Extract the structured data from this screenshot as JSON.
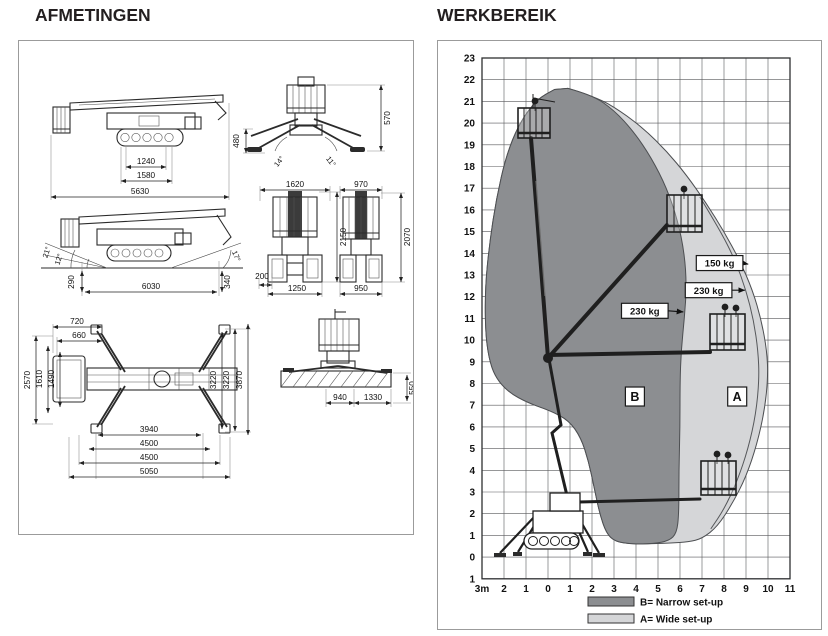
{
  "left_panel": {
    "title": "AFMETINGEN",
    "side_view_stowed": {
      "v1": "1240",
      "v2": "1580",
      "v3": "5630"
    },
    "rear_view_outriggers": {
      "h_right": "570",
      "h_left": "480",
      "ang1": "14°",
      "ang2": "11°"
    },
    "side_view_grade": {
      "ang_up": "21°",
      "ang_mid": "12°",
      "ang_rear": "17°",
      "h_front": "290",
      "length": "6030",
      "h_rear": "340"
    },
    "front_view_wide": {
      "w_top": "1620",
      "height": "2150",
      "offset": "200",
      "w_track": "1250"
    },
    "front_view_narrow": {
      "w_top": "970",
      "height": "2070",
      "w_track": "950"
    },
    "plan_view": {
      "t1": "720",
      "t2": "660",
      "l1": "2570",
      "l2": "1610",
      "l3": "1490",
      "r1": "3220",
      "r2": "3220",
      "r3": "3870",
      "b1": "3940",
      "b2": "4500",
      "b3": "4500",
      "b4": "5050"
    },
    "slab_view": {
      "b1": "940",
      "b2": "1330",
      "r1": "550"
    }
  },
  "right_panel": {
    "title": "WERKBEREIK"
  },
  "chart_data": {
    "type": "area",
    "title": "WERKBEREIK",
    "x_axis": {
      "unit": "m",
      "min": -3,
      "max": 11,
      "tick_labels": [
        "3m",
        "2",
        "1",
        "0",
        "1",
        "2",
        "3",
        "4",
        "5",
        "6",
        "7",
        "8",
        "9",
        "10",
        "11"
      ]
    },
    "y_axis": {
      "unit": "m",
      "min": -1,
      "max": 23,
      "tick_labels": [
        "23",
        "22",
        "21",
        "20",
        "19",
        "18",
        "17",
        "16",
        "15",
        "14",
        "13",
        "12",
        "11",
        "10",
        "9",
        "8",
        "7",
        "6",
        "5",
        "4",
        "3",
        "2",
        "1",
        "0",
        "1"
      ]
    },
    "grid": true,
    "regions": [
      {
        "id": "A",
        "label": "A",
        "name": "Wide set-up",
        "color": "#d5d6d8",
        "outline": [
          [
            0.9,
            21.6
          ],
          [
            2.2,
            21.2
          ],
          [
            3.3,
            20.55
          ],
          [
            4.4,
            19.7
          ],
          [
            5.4,
            18.7
          ],
          [
            6.3,
            17.6
          ],
          [
            7.2,
            16.3
          ],
          [
            8.0,
            15.0
          ],
          [
            8.7,
            13.7
          ],
          [
            9.3,
            12.3
          ],
          [
            9.7,
            10.9
          ],
          [
            9.95,
            9.5
          ],
          [
            10.0,
            8.3
          ],
          [
            9.85,
            6.8
          ],
          [
            9.5,
            5.2
          ],
          [
            9.0,
            3.7
          ],
          [
            8.4,
            2.5
          ],
          [
            7.7,
            1.4
          ],
          [
            7.0,
            0.85
          ],
          [
            6.4,
            0.7
          ],
          [
            5.55,
            0.65
          ],
          [
            4.8,
            0.62
          ],
          [
            3.8,
            0.6
          ],
          [
            3.05,
            0.72
          ],
          [
            2.65,
            1.1
          ],
          [
            2.35,
            2.0
          ],
          [
            2.1,
            3.2
          ],
          [
            1.85,
            4.4
          ],
          [
            1.5,
            5.5
          ],
          [
            0.95,
            6.3
          ],
          [
            0.1,
            6.75
          ],
          [
            -0.9,
            7.1
          ],
          [
            -1.8,
            7.6
          ],
          [
            -2.4,
            8.3
          ],
          [
            -2.7,
            9.2
          ],
          [
            -2.85,
            10.5
          ],
          [
            -2.85,
            12.5
          ],
          [
            -2.65,
            14.5
          ],
          [
            -2.35,
            16.5
          ],
          [
            -1.9,
            18.5
          ],
          [
            -1.3,
            20.0
          ],
          [
            -0.5,
            21.1
          ],
          [
            0.3,
            21.55
          ]
        ]
      },
      {
        "id": "B",
        "label": "B",
        "name": "Narrow set-up",
        "color": "#8c8e91",
        "outline": [
          [
            0.9,
            21.6
          ],
          [
            2.0,
            21.3
          ],
          [
            3.0,
            20.6
          ],
          [
            3.9,
            19.6
          ],
          [
            4.7,
            18.4
          ],
          [
            5.4,
            17.0
          ],
          [
            5.9,
            15.5
          ],
          [
            6.2,
            14.0
          ],
          [
            6.3,
            12.5
          ],
          [
            6.2,
            11.0
          ],
          [
            6.05,
            9.5
          ],
          [
            6.0,
            8.0
          ],
          [
            6.0,
            6.0
          ],
          [
            5.95,
            4.0
          ],
          [
            5.95,
            2.0
          ],
          [
            5.85,
            1.1
          ],
          [
            5.5,
            0.75
          ],
          [
            4.8,
            0.62
          ],
          [
            3.8,
            0.6
          ],
          [
            3.05,
            0.72
          ],
          [
            2.65,
            1.1
          ],
          [
            2.35,
            2.0
          ],
          [
            2.1,
            3.2
          ],
          [
            1.85,
            4.4
          ],
          [
            1.5,
            5.5
          ],
          [
            0.95,
            6.3
          ],
          [
            0.1,
            6.75
          ],
          [
            -0.9,
            7.1
          ],
          [
            -1.8,
            7.6
          ],
          [
            -2.4,
            8.3
          ],
          [
            -2.7,
            9.2
          ],
          [
            -2.85,
            10.5
          ],
          [
            -2.85,
            12.5
          ],
          [
            -2.65,
            14.5
          ],
          [
            -2.35,
            16.5
          ],
          [
            -1.9,
            18.5
          ],
          [
            -1.3,
            20.0
          ],
          [
            -0.5,
            21.1
          ],
          [
            0.3,
            21.55
          ]
        ]
      }
    ],
    "divider_line": [
      [
        6.9,
        16.6
      ],
      [
        7.8,
        15.1
      ],
      [
        8.5,
        13.7
      ],
      [
        9.0,
        12.3
      ],
      [
        9.35,
        10.9
      ],
      [
        9.55,
        9.5
      ],
      [
        9.6,
        8.2
      ],
      [
        9.45,
        6.6
      ],
      [
        9.1,
        5.0
      ],
      [
        8.6,
        3.5
      ],
      [
        8.0,
        2.2
      ],
      [
        7.4,
        1.3
      ]
    ],
    "annotations": [
      {
        "text": "150 kg",
        "at": [
          7.8,
          13.55
        ],
        "arrow_to": [
          9.1,
          13.5
        ]
      },
      {
        "text": "230 kg",
        "at": [
          7.3,
          12.3
        ],
        "arrow_to": [
          8.95,
          12.3
        ]
      },
      {
        "text": "230 kg",
        "at": [
          4.4,
          11.35
        ],
        "arrow_to": [
          6.15,
          11.3
        ]
      },
      {
        "text": "B",
        "at": [
          3.95,
          7.4
        ]
      },
      {
        "text": "A",
        "at": [
          8.6,
          7.4
        ]
      }
    ],
    "legend": [
      {
        "swatch_color": "#8c8e91",
        "label": "B= Narrow set-up"
      },
      {
        "swatch_color": "#d5d6d8",
        "label": "A= Wide set-up"
      }
    ]
  }
}
